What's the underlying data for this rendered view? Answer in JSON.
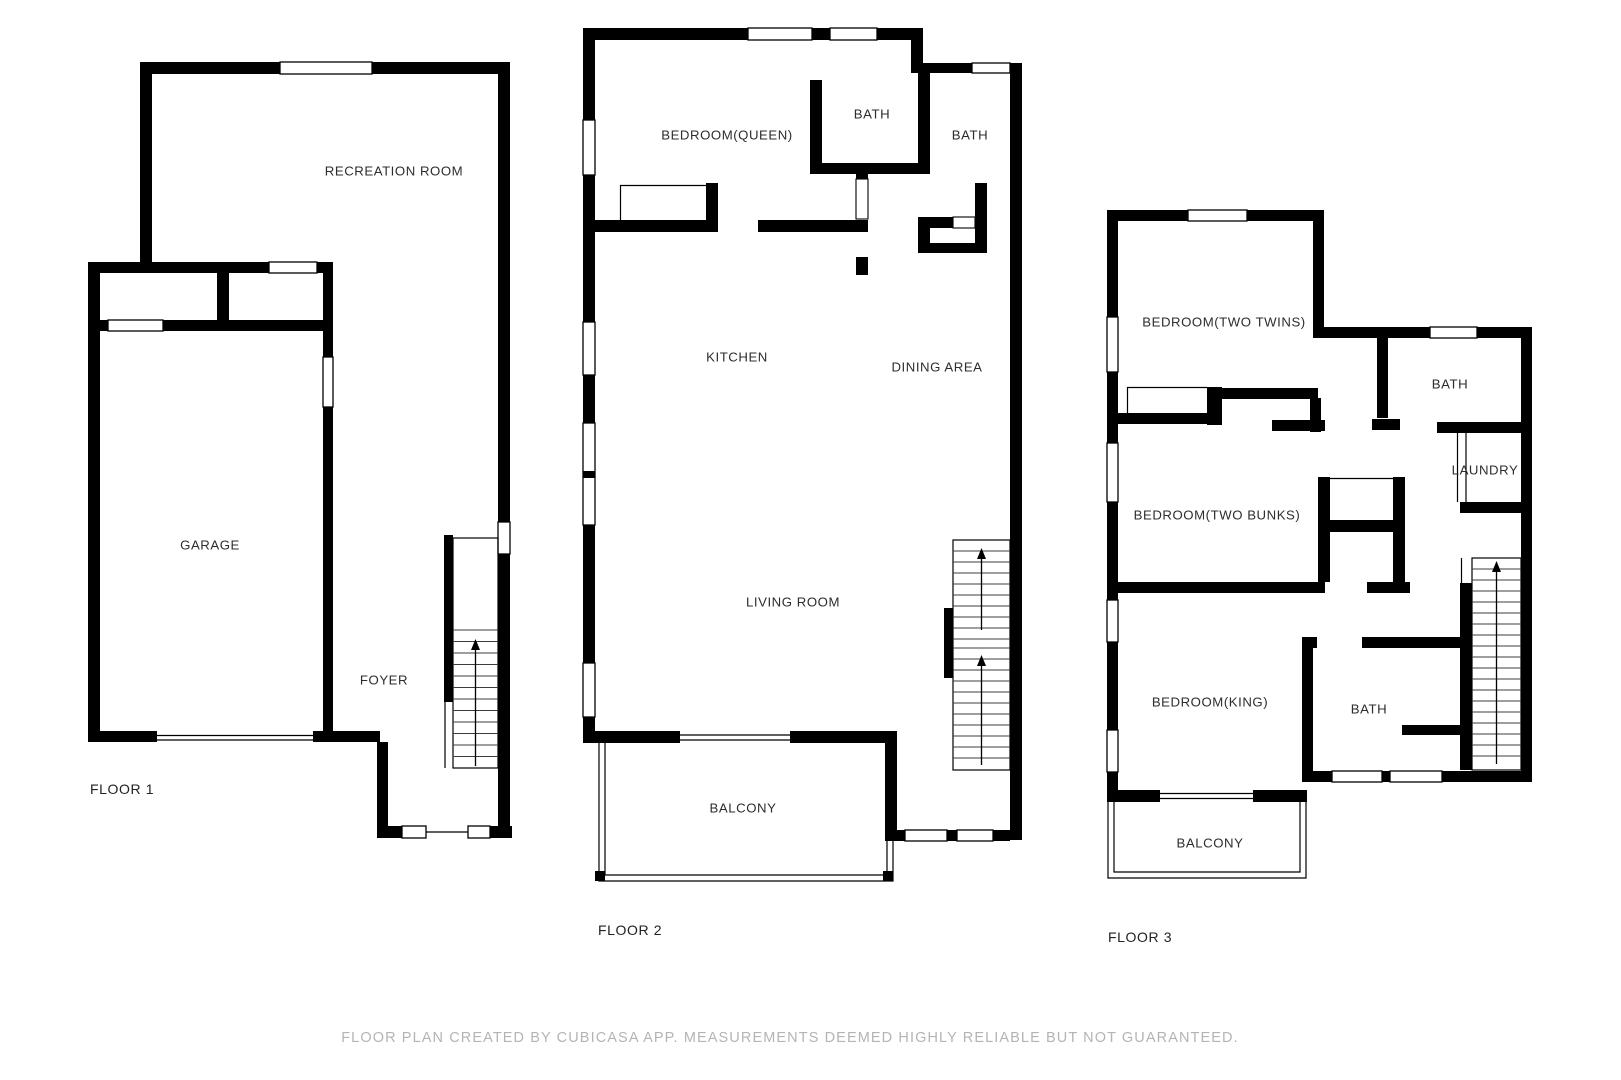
{
  "floors": [
    {
      "label": "FLOOR 1",
      "rooms": [
        {
          "id": "recreation-room",
          "label": "RECREATION ROOM"
        },
        {
          "id": "garage",
          "label": "GARAGE"
        },
        {
          "id": "foyer",
          "label": "FOYER"
        }
      ]
    },
    {
      "label": "FLOOR 2",
      "rooms": [
        {
          "id": "bedroom-queen",
          "label": "BEDROOM(QUEEN)"
        },
        {
          "id": "bath-1",
          "label": "BATH"
        },
        {
          "id": "bath-2",
          "label": "BATH"
        },
        {
          "id": "kitchen",
          "label": "KITCHEN"
        },
        {
          "id": "dining-area",
          "label": "DINING AREA"
        },
        {
          "id": "living-room",
          "label": "LIVING ROOM"
        },
        {
          "id": "balcony",
          "label": "BALCONY"
        }
      ]
    },
    {
      "label": "FLOOR 3",
      "rooms": [
        {
          "id": "bedroom-two-twins",
          "label": "BEDROOM(TWO TWINS)"
        },
        {
          "id": "bath-upper",
          "label": "BATH"
        },
        {
          "id": "laundry",
          "label": "LAUNDRY"
        },
        {
          "id": "bedroom-two-bunks",
          "label": "BEDROOM(TWO BUNKS)"
        },
        {
          "id": "bedroom-king",
          "label": "BEDROOM(KING)"
        },
        {
          "id": "bath-lower",
          "label": "BATH"
        },
        {
          "id": "balcony",
          "label": "BALCONY"
        }
      ]
    }
  ],
  "disclaimer": "FLOOR PLAN CREATED BY CUBICASA APP. MEASUREMENTS DEEMED HIGHLY RELIABLE BUT NOT GUARANTEED.",
  "colors": {
    "wall": "#000000",
    "room_label": "#2d2d2d",
    "disclaimer": "#b4b4b4",
    "background": "#ffffff"
  }
}
